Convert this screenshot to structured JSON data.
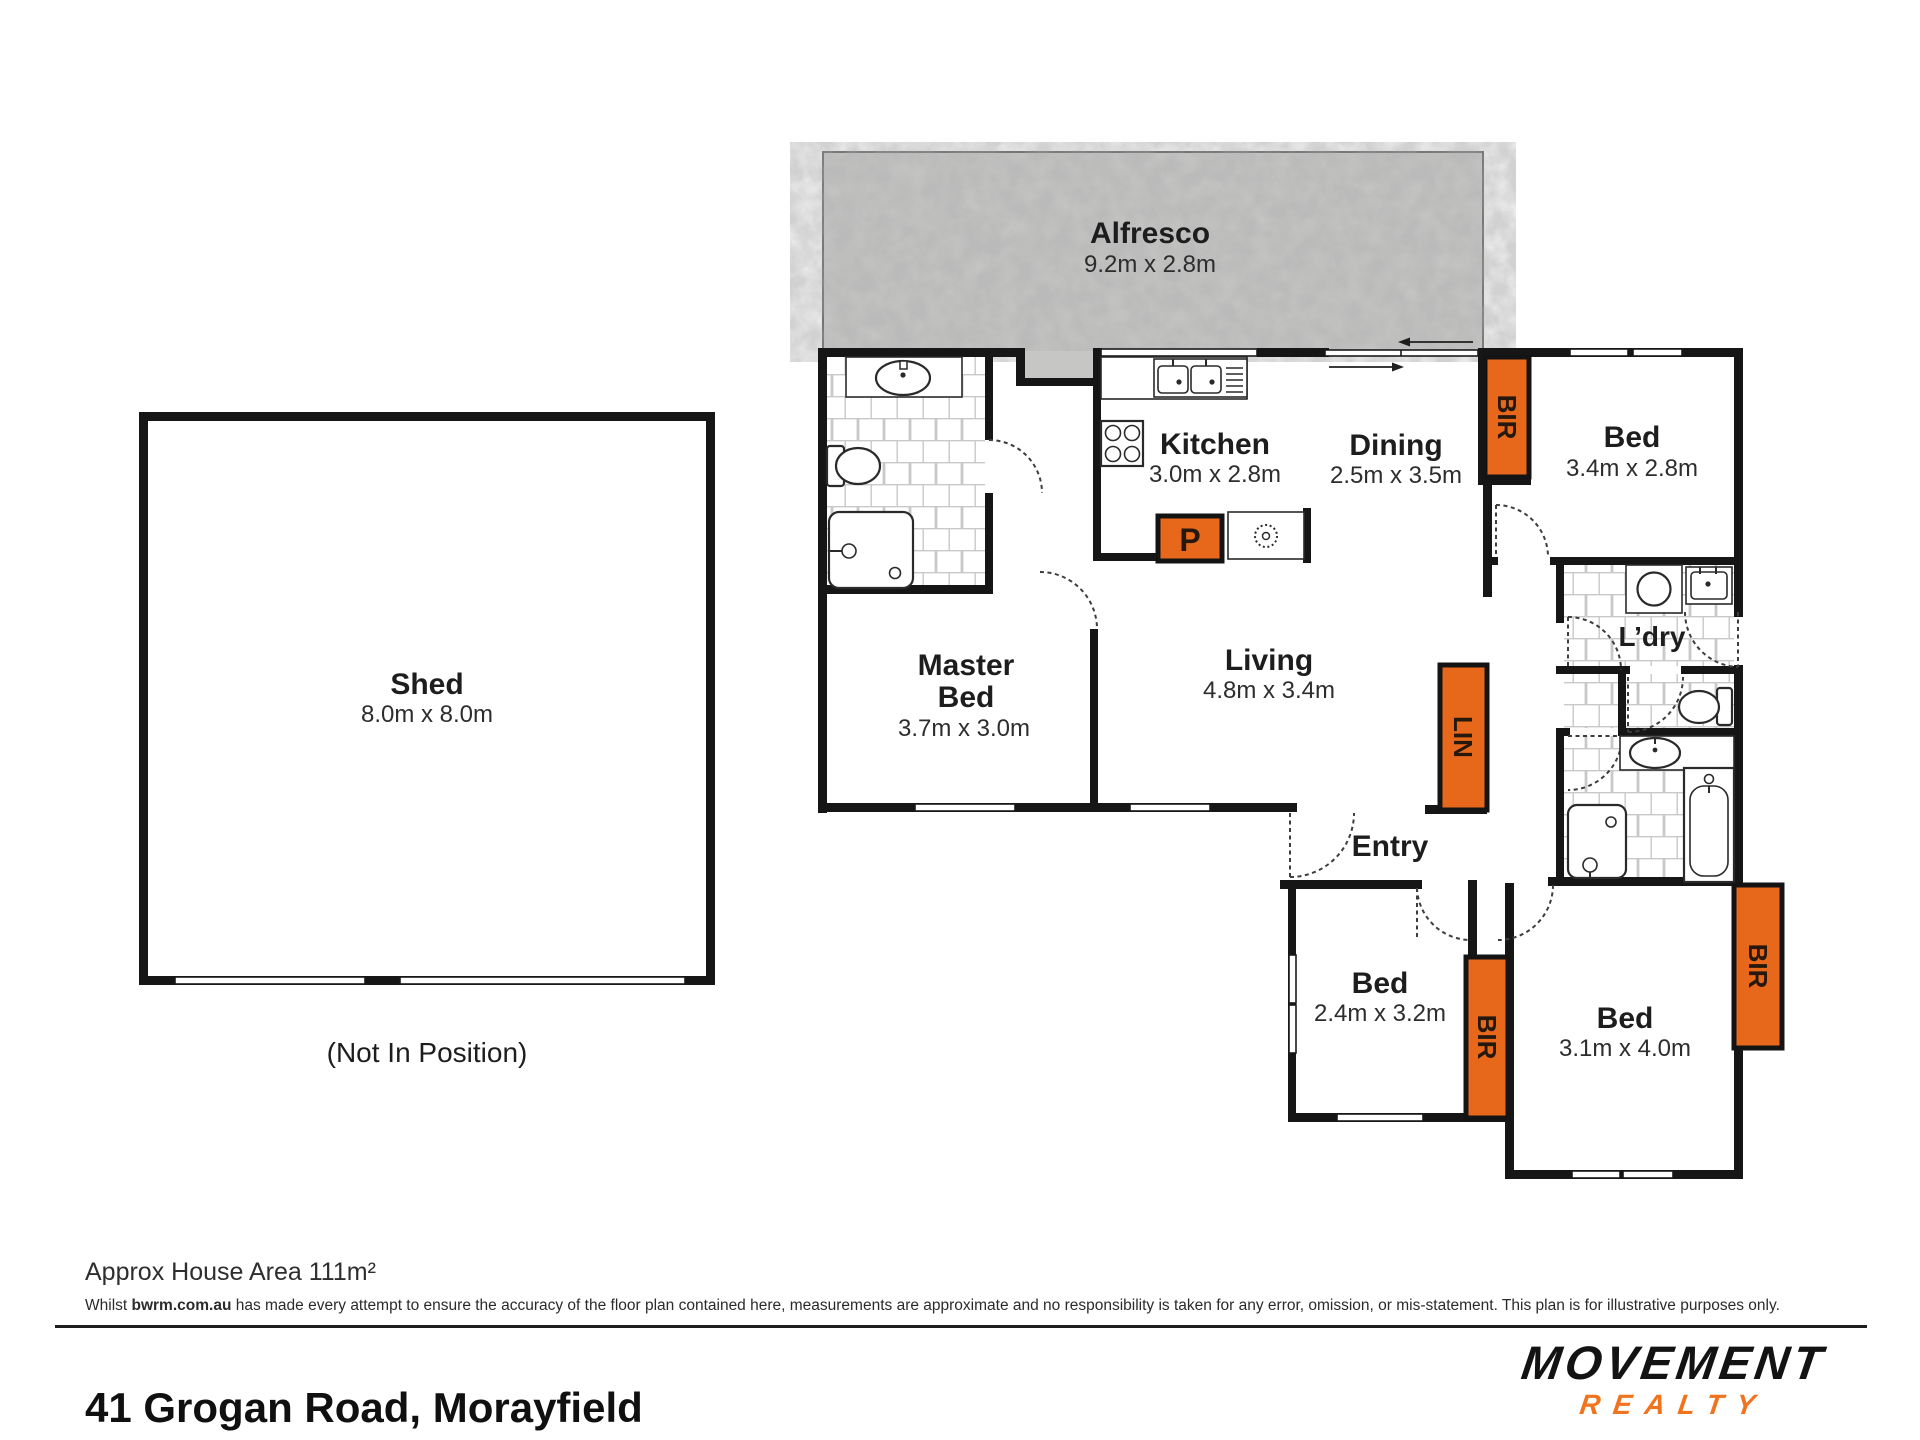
{
  "plan": {
    "shed": {
      "name": "Shed",
      "dims": "8.0m x 8.0m",
      "note": "(Not In Position)"
    },
    "rooms": {
      "alfresco": {
        "name": "Alfresco",
        "dims": "9.2m x 2.8m"
      },
      "kitchen": {
        "name": "Kitchen",
        "dims": "3.0m x 2.8m"
      },
      "dining": {
        "name": "Dining",
        "dims": "2.5m x 3.5m"
      },
      "bed1": {
        "name": "Bed",
        "dims": "3.4m x 2.8m"
      },
      "master": {
        "line1": "Master",
        "line2": "Bed",
        "dims": "3.7m x 3.0m"
      },
      "living": {
        "name": "Living",
        "dims": "4.8m x 3.4m"
      },
      "laundry": {
        "name": "L’dry"
      },
      "entry": {
        "name": "Entry"
      },
      "bed2": {
        "name": "Bed",
        "dims": "2.4m x 3.2m"
      },
      "bed3": {
        "name": "Bed",
        "dims": "3.1m x 4.0m"
      }
    },
    "closets": {
      "bir": "BIR",
      "lin": "LIN",
      "pantry": "P"
    }
  },
  "footer": {
    "area_label": "Approx House Area 111m²",
    "disclaimer_prefix": "Whilst ",
    "disclaimer_bold": "bwrm.com.au",
    "disclaimer_rest": " has made every attempt to ensure the accuracy of the floor plan contained here, measurements are approximate and no responsibility is taken for any error, omission, or mis-statement. This plan is for illustrative purposes only.",
    "address": "41 Grogan Road, Morayfield",
    "logo_primary": "MOVEMENT",
    "logo_secondary": "REALTY"
  },
  "colors": {
    "closet_orange": "#E8681B",
    "logo_orange": "#F0731F",
    "wall_black": "#161616",
    "concrete_gray": "#cbcbca"
  }
}
